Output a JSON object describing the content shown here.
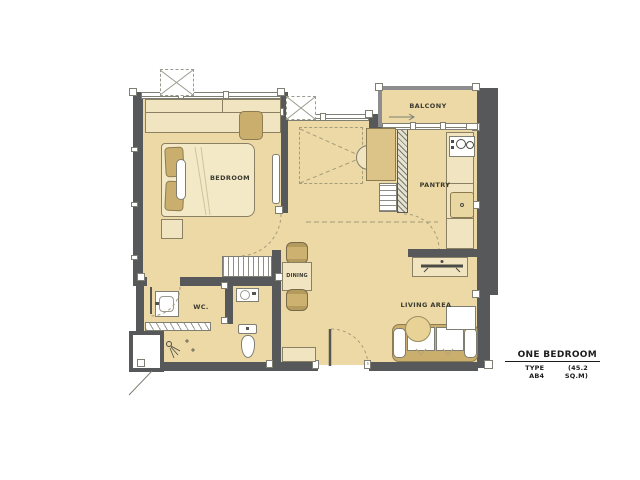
{
  "rooms": {
    "bedroom": {
      "label": "BEDROOM"
    },
    "balcony": {
      "label": "BALCONY"
    },
    "pantry": {
      "label": "PANTRY"
    },
    "dining": {
      "label": "DINING"
    },
    "wc": {
      "label": "WC."
    },
    "living": {
      "label": "LIVING AREA"
    }
  },
  "legend": {
    "name": "ONE BEDROOM",
    "type": "TYPE AB4",
    "area": "(45.2 SQ.M)"
  },
  "colors": {
    "floor": "#ecd9a6",
    "wall": "#57585a",
    "furniture_light": "#f0e5c0",
    "furniture_cream": "#f3e9c6",
    "furniture_tan": "#c9ae6e",
    "outline": "#8a8165",
    "label_text": "#3a3a30"
  }
}
